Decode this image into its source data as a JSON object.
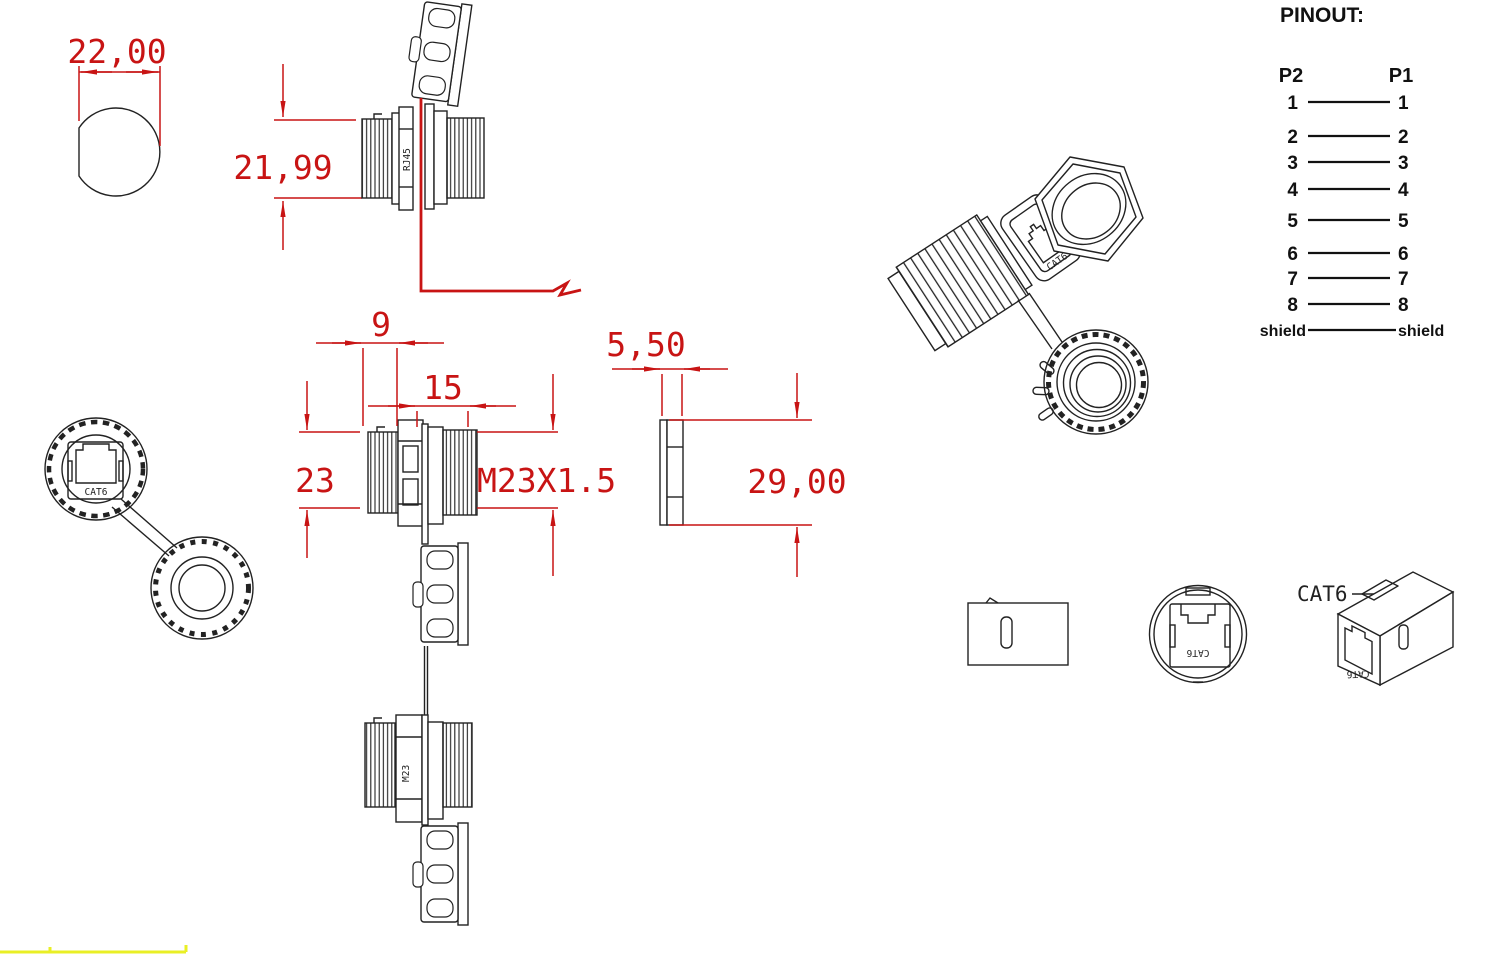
{
  "colors": {
    "dimension_red": "#c81414",
    "line_black": "#222222",
    "highlight_yellow": "#e9ef25",
    "background": "#ffffff"
  },
  "dimensions": {
    "cutout_width": "22,00",
    "cutout_height": "21,99",
    "front_thread_length": "9",
    "rear_thread_length": "15",
    "front_outer_diameter": "23",
    "thread_spec": "M23X1.5",
    "nut_thickness": "5,50",
    "nut_width": "29,00"
  },
  "part_markings": {
    "jack_type": "RJ45",
    "thread_type": "M23",
    "front_view_label": "CAT6",
    "iso_view_label": "CAT6",
    "round_view_label": "CAT6",
    "coupler_front_label": "CAT6",
    "coupler_callout": "CAT6"
  },
  "pinout": {
    "title": "PINOUT:",
    "left_header": "P2",
    "right_header": "P1",
    "rows": [
      {
        "p2": "1",
        "p1": "1"
      },
      {
        "p2": "2",
        "p1": "2"
      },
      {
        "p2": "3",
        "p1": "3"
      },
      {
        "p2": "4",
        "p1": "4"
      },
      {
        "p2": "5",
        "p1": "5"
      },
      {
        "p2": "6",
        "p1": "6"
      },
      {
        "p2": "7",
        "p1": "7"
      },
      {
        "p2": "8",
        "p1": "8"
      },
      {
        "p2": "shield",
        "p1": "shield"
      }
    ]
  }
}
